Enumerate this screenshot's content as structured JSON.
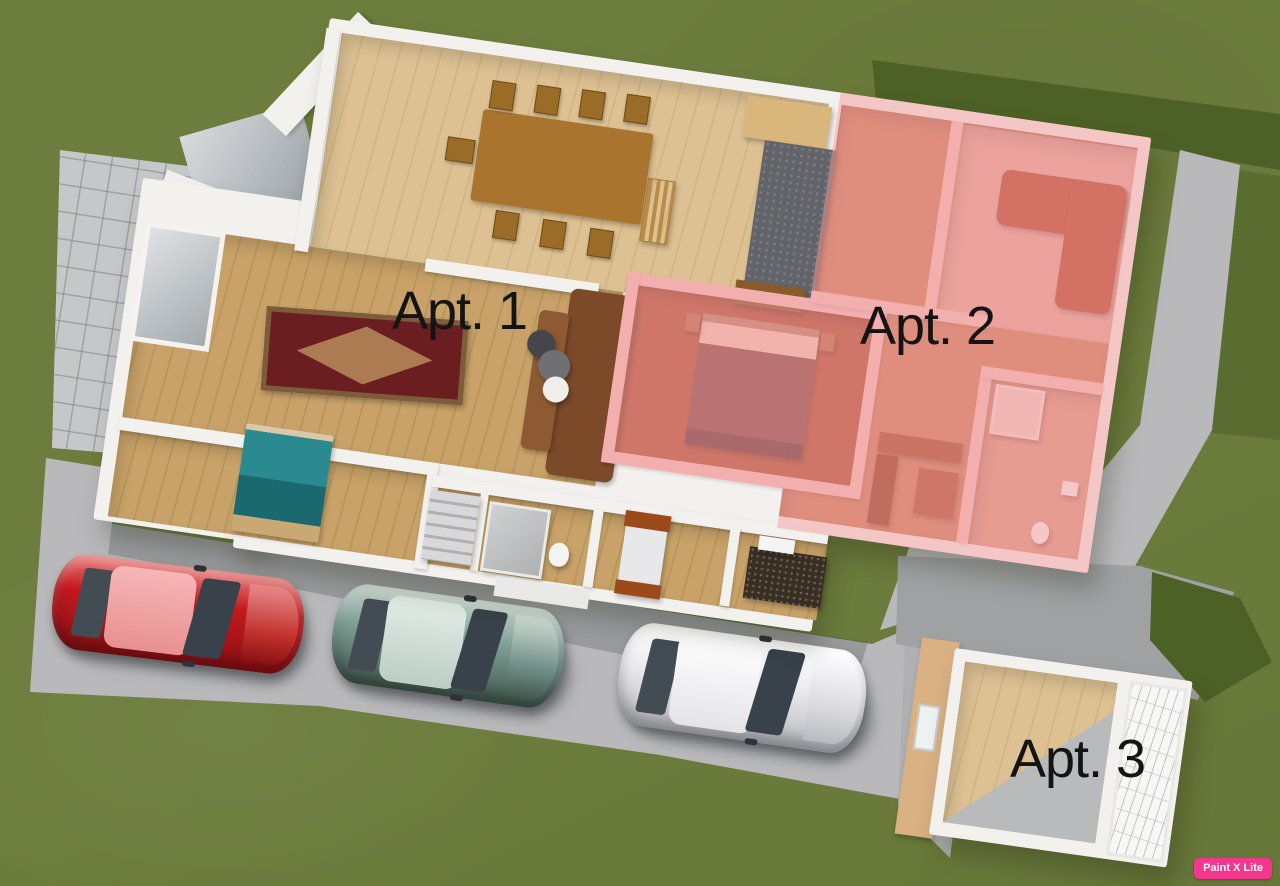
{
  "canvas": {
    "width": 1280,
    "height": 886
  },
  "labels": {
    "apt1": "Apt. 1",
    "apt2": "Apt. 2",
    "apt3": "Apt. 3"
  },
  "watermark": {
    "text": "Paint X Lite"
  },
  "colors": {
    "grass": "#6d7d3d",
    "grass_shadow": "#4d6126",
    "pavement": "#b9b9bb",
    "tile": "#c6c7c9",
    "wall_white": "#f2f1ee",
    "wood_light": "#ddc193",
    "wood_mid": "#c8a268",
    "wood_dark": "#a9752e",
    "terracotta": "#b65c3e",
    "terracotta_dark": "#a84f34",
    "pink_overlay": "rgba(246,158,158,0.5)",
    "pink_wall": "#f0bfbf",
    "pink_floor": "#e2a79c",
    "rust_sofa": "#b0452a",
    "rug_red": "#6b1e20",
    "teal_bed": "#1f7a80",
    "tan_wall": "#d9b183",
    "car_red": "#c2181d",
    "car_teal": "#7fa096",
    "car_white": "#ececee",
    "label_text": "#141414",
    "watermark_bg": "#f5368f",
    "watermark_text": "#ffffff"
  },
  "scene_elements": {
    "apartments": [
      {
        "name": "apartment-1",
        "label": "Apt. 1",
        "highlight": "none"
      },
      {
        "name": "apartment-2",
        "label": "Apt. 2",
        "highlight": "pink"
      },
      {
        "name": "apartment-3",
        "label": "Apt. 3",
        "highlight": "none"
      }
    ],
    "cars": [
      {
        "name": "red-car",
        "color": "#c2181d"
      },
      {
        "name": "teal-car",
        "color": "#7fa096"
      },
      {
        "name": "white-car",
        "color": "#ececee"
      }
    ]
  }
}
